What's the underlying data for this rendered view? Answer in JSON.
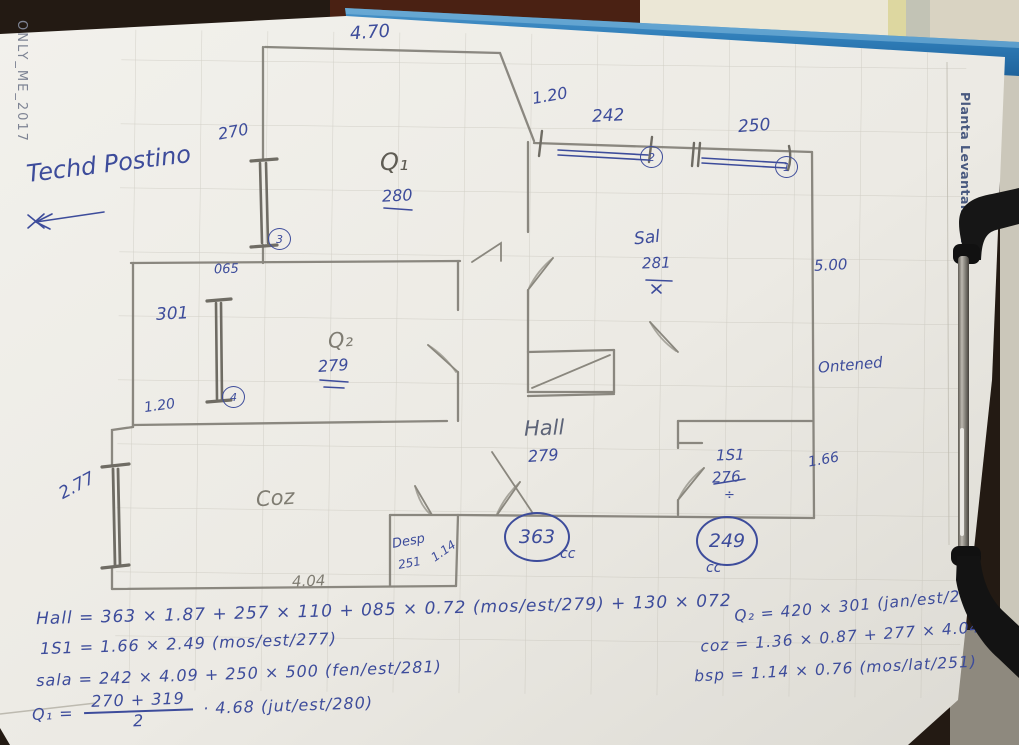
{
  "photo": {
    "watermark": "ONLY_ME_2017",
    "side_label": "Planta Levantamento"
  },
  "colors": {
    "ink_blue": "#3d4c9b",
    "pencil_gray": "#84817a",
    "clipboard_blue": "#2f7db8",
    "paper": "#edece6"
  },
  "notes": {
    "techo": "Techd Postino"
  },
  "ann": {
    "top_width": "4.70",
    "n120_top": "1.20",
    "w242": "242",
    "w242_id": "2",
    "w250": "250",
    "w250_id": "1",
    "win270": "270",
    "door3": "3",
    "n065": "065",
    "n301": "301",
    "door4": "4",
    "n120_left": "1.20",
    "q1_label": "Q₁",
    "q1_val": "280",
    "q2_label": "Q₂",
    "q2_val": "279",
    "sala_label": "Sal",
    "sala_val": "281",
    "n500": "5.00",
    "ontened": "Ontened",
    "hall_label": "Hall",
    "hall_val": "279",
    "s1_label": "1S1",
    "s1_val": "276",
    "s1_div": "÷",
    "n166": "1.66",
    "n277": "2.77",
    "coz_label": "Coz",
    "c363": "363",
    "c363_cc": "cc",
    "c249": "249",
    "c249_cc": "cc",
    "desp_label": "Desp",
    "desp_val": "251",
    "n114": "1.14",
    "n404": "4.04"
  },
  "equations": {
    "hall": "Hall = 363 × 1.87 + 257 × 110 + 085 × 0.72 (mos/est/279) + 130 × 072",
    "s1": "1S1 = 1.66 × 2.49 (mos/est/277)",
    "sala": "sala = 242 × 4.09 + 250 × 500 (fen/est/281)",
    "q1_lhs": "Q₁ =",
    "q1_num": "270 + 319",
    "q1_den": "2",
    "q1_rhs": "· 4.68 (jut/est/280)",
    "q2": "Q₂ = 420 × 301 (jan/est/279)",
    "coz": "coz = 1.36 × 0.87 + 277 × 4.04",
    "bsp": "bsp = 1.14 × 0.76 (mos/lat/251)"
  }
}
